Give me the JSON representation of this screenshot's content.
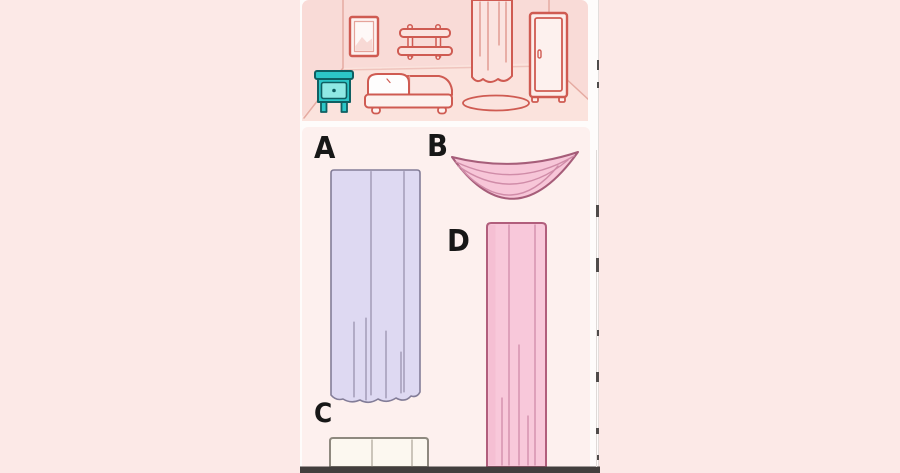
{
  "game": {
    "options": {
      "a": {
        "label": "A",
        "item": "long-pleated-curtain-lavender",
        "fill": "#ded9f2",
        "outline": "#837d98",
        "fold": "#8d86a2"
      },
      "b": {
        "label": "B",
        "item": "swag-valance-pink",
        "fill": "#f7c6d8",
        "outline": "#a65d79",
        "fold": "#d08ca8"
      },
      "c": {
        "label": "C",
        "item": "plain-folded-panel-cream",
        "fill": "#fcf8f0",
        "outline": "#8e897f",
        "fold": "#aba496"
      },
      "d": {
        "label": "D",
        "item": "long-curtain-pink",
        "fill": "#f8c8da",
        "outline": "#b15e7c",
        "fold": "#cf8aa8",
        "shade": "#f4bad0"
      }
    }
  },
  "scene": {
    "description": "bedroom-outline-illustration",
    "wall": "#f9dbd7",
    "floor": "#fbe3dd",
    "outline": "#cf5b52",
    "wall_line": "#e5aba2",
    "nightstand_color": "#2cc6c7",
    "nightstand_drawer": "#8fe9e4",
    "nightstand_outline": "#0f5f62",
    "objects": [
      "picture-frame",
      "wall-shelf",
      "window-curtain",
      "wardrobe",
      "nightstand",
      "bed",
      "rug"
    ]
  },
  "ui": {
    "page_background": "#fce9e7",
    "video_background": "#fefcfb",
    "panel_background": "#fdf0ee",
    "bottom_bar_color": "#423e3d",
    "letter_color": "#171717"
  }
}
